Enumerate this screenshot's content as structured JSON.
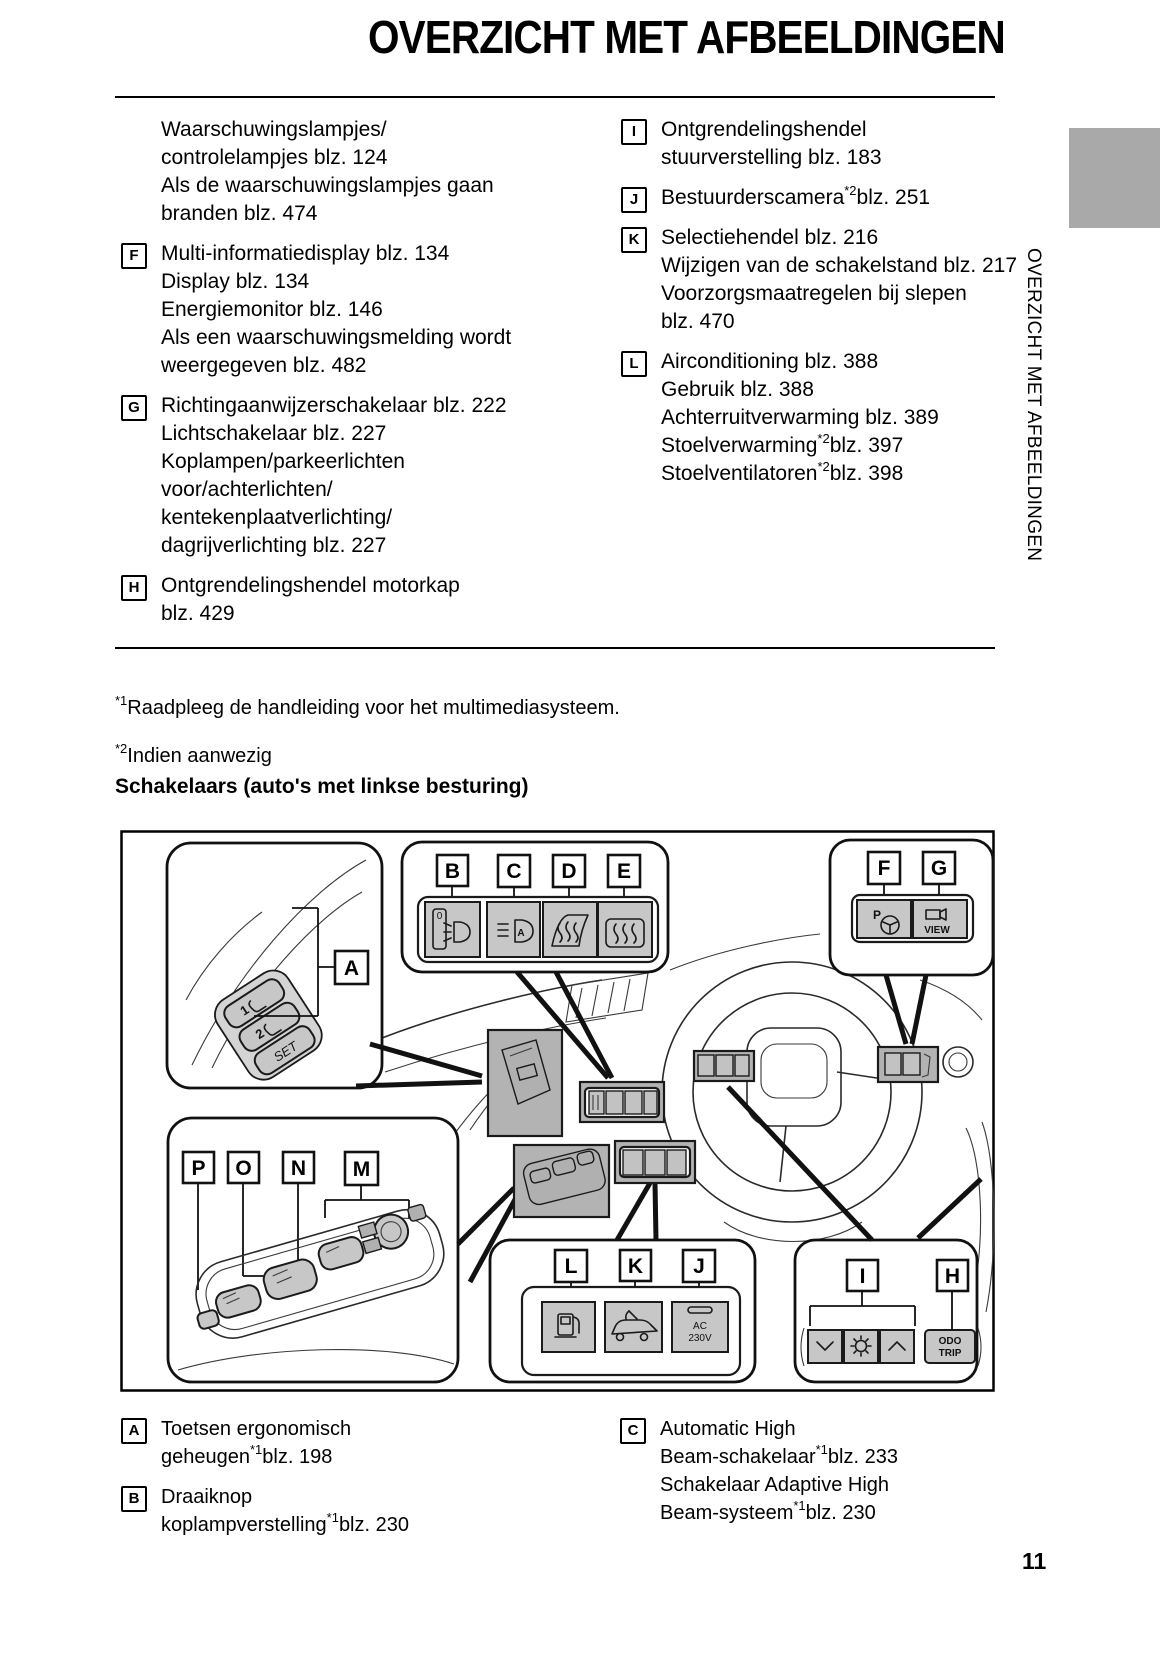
{
  "page": {
    "title": "OVERZICHT MET AFBEELDINGEN",
    "number": "11"
  },
  "sidebar": {
    "vertical_label": "OVERZICHT MET AFBEELDINGEN"
  },
  "section_heading": "Schakelaars (auto's met linkse besturing)",
  "footnotes": [
    [
      {
        "sup": "*1"
      },
      "Raadpleeg de handleiding voor het multimediasysteem."
    ],
    [
      {
        "sup": "*2"
      },
      "Indien aanwezig"
    ]
  ],
  "index": {
    "left": [
      {
        "letter": null,
        "lines": [
          [
            "Waarschuwingslampjes/"
          ],
          [
            "controlelampjes blz. 124"
          ],
          [
            "Als de waarschuwingslampjes gaan"
          ],
          [
            "branden blz. 474"
          ]
        ]
      },
      {
        "letter": "F",
        "lines": [
          [
            "Multi-informatiedisplay blz. 134"
          ],
          [
            "Display blz. 134"
          ],
          [
            "Energiemonitor blz. 146"
          ],
          [
            "Als een waarschuwingsmelding wordt"
          ],
          [
            "weergegeven blz. 482"
          ]
        ]
      },
      {
        "letter": "G",
        "lines": [
          [
            "Richtingaanwijzerschakelaar blz. 222"
          ],
          [
            "Lichtschakelaar blz. 227"
          ],
          [
            "Koplampen/parkeerlichten"
          ],
          [
            "voor/achterlichten/"
          ],
          [
            "kentekenplaatverlichting/"
          ],
          [
            "dagrijverlichting blz. 227"
          ]
        ]
      },
      {
        "letter": "H",
        "lines": [
          [
            "Ontgrendelingshendel motorkap"
          ],
          [
            "blz. 429"
          ]
        ]
      }
    ],
    "right": [
      {
        "letter": "I",
        "lines": [
          [
            "Ontgrendelingshendel"
          ],
          [
            "stuurverstelling blz. 183"
          ]
        ]
      },
      {
        "letter": "J",
        "lines": [
          [
            "Bestuurderscamera",
            {
              "sup": "*2"
            },
            "blz. 251"
          ]
        ]
      },
      {
        "letter": "K",
        "lines": [
          [
            "Selectiehendel blz. 216"
          ],
          [
            "Wijzigen van de schakelstand blz. 217"
          ],
          [
            "Voorzorgsmaatregelen bij slepen"
          ],
          [
            "blz. 470"
          ]
        ]
      },
      {
        "letter": "L",
        "lines": [
          [
            "Airconditioning blz. 388"
          ],
          [
            "Gebruik blz. 388"
          ],
          [
            "Achterruitverwarming blz. 389"
          ],
          [
            "Stoelverwarming",
            {
              "sup": "*2"
            },
            "blz. 397"
          ],
          [
            "Stoelventilatoren",
            {
              "sup": "*2"
            },
            "blz. 398"
          ]
        ]
      }
    ]
  },
  "bottom": {
    "left": [
      {
        "letter": "A",
        "lines": [
          [
            "Toetsen ergonomisch"
          ],
          [
            "geheugen",
            {
              "sup": "*1"
            },
            "blz. 198"
          ]
        ]
      },
      {
        "letter": "B",
        "lines": [
          [
            "Draaiknop"
          ],
          [
            "koplampverstelling",
            {
              "sup": "*1"
            },
            "blz. 230"
          ]
        ]
      }
    ],
    "right": [
      {
        "letter": "C",
        "lines": [
          [
            "Automatic High"
          ],
          [
            "Beam-schakelaar",
            {
              "sup": "*1"
            },
            "blz. 233"
          ],
          [
            "Schakelaar Adaptive High"
          ],
          [
            "Beam-systeem",
            {
              "sup": "*1"
            },
            "blz. 230"
          ]
        ]
      }
    ]
  },
  "diagram": {
    "callouts": {
      "A": "A",
      "B": "B",
      "C": "C",
      "D": "D",
      "E": "E",
      "F": "F",
      "G": "G",
      "H": "H",
      "I": "I",
      "J": "J",
      "K": "K",
      "L": "L",
      "M": "M",
      "N": "N",
      "O": "O",
      "P": "P"
    },
    "button_labels": {
      "p": "P",
      "view": "VIEW",
      "ac_line1": "AC",
      "ac_line2": "230V",
      "odo_line1": "ODO",
      "odo_line2": "TRIP",
      "set": "SET",
      "mem1": "1",
      "mem2": "2",
      "dial_zero": "0",
      "ahb_a": "A"
    }
  }
}
